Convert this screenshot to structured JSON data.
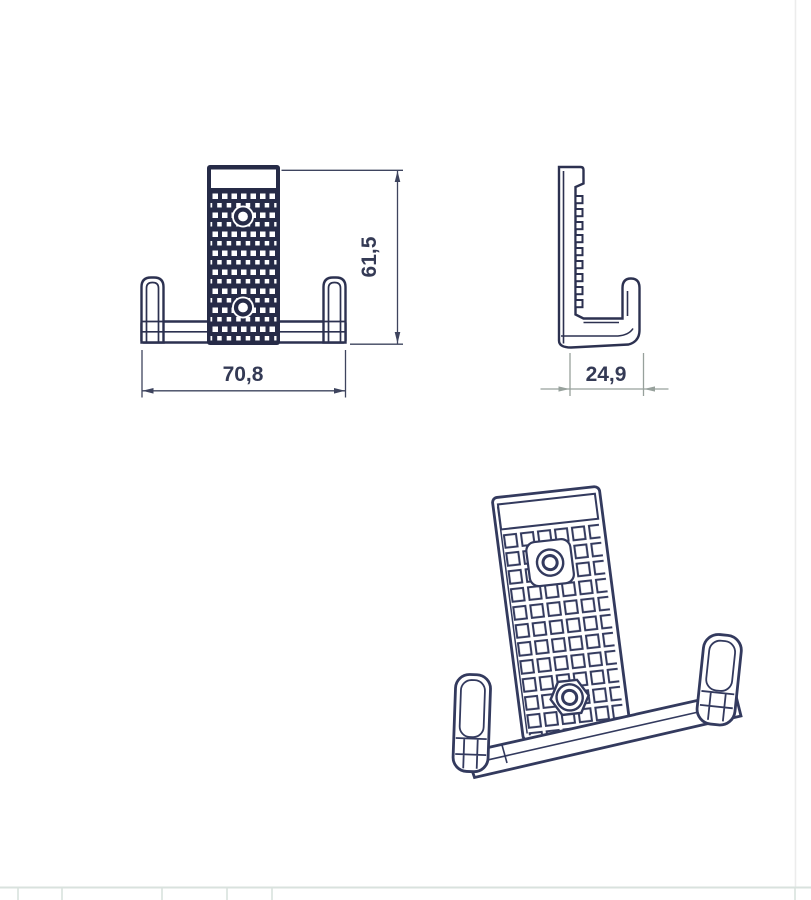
{
  "drawing": {
    "part": "double-wall-hook-bracket",
    "views": [
      {
        "id": "front",
        "name": "front-view"
      },
      {
        "id": "side",
        "name": "side-profile-view"
      },
      {
        "id": "isometric",
        "name": "isometric-view"
      }
    ],
    "dimensions": {
      "front_width": "70,8",
      "front_height": "61,5",
      "side_depth": "24,9"
    },
    "colors": {
      "part_line": "#2c3150",
      "plate_fill": "#262b47",
      "iso_line": "#333a5e",
      "dimension_navy": "#3e445e",
      "dimension_gray": "#97a19c",
      "text": "#343a55",
      "sheet_gridline": "#d9e2de",
      "page_border": "#ececec"
    }
  }
}
